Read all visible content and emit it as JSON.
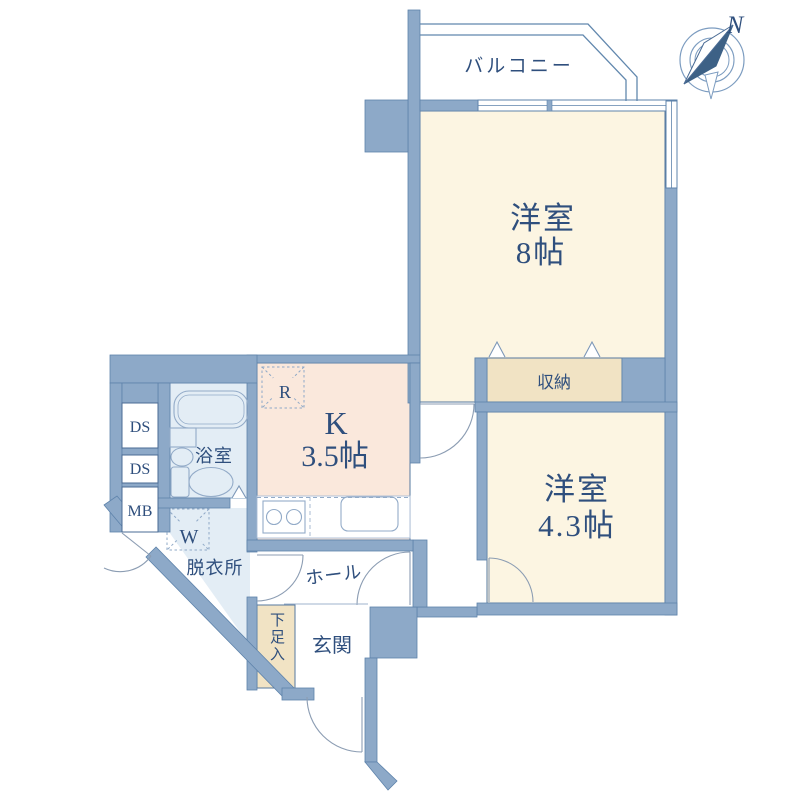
{
  "compass": {
    "north_label": "N"
  },
  "balcony": {
    "label": "バルコニー"
  },
  "rooms": {
    "western8": {
      "name": "洋室",
      "size": "8帖"
    },
    "western43": {
      "name": "洋室",
      "size": "4.3帖"
    },
    "kitchen": {
      "name": "K",
      "size": "3.5帖"
    },
    "storage": {
      "label": "収納"
    },
    "bathroom": {
      "label": "浴室"
    },
    "dressing_room": {
      "label": "脱衣所"
    },
    "hall": {
      "label": "ホール"
    },
    "entrance": {
      "label": "玄関"
    },
    "shoe_cabinet": {
      "label": "下足入"
    }
  },
  "equipment": {
    "duct_shaft_1": "DS",
    "duct_shaft_2": "DS",
    "meter_box": "MB",
    "refrigerator": "R",
    "washing_machine": "W"
  },
  "colors": {
    "wall": "#8DA9C8",
    "wall_edge": "#5E83AB",
    "room_floor": "#FCF5E2",
    "kitchen_floor": "#FAE8DC",
    "closet_floor": "#F1E3C4",
    "wet_area_floor": "#E3EDF5",
    "text": "#2F4F7D"
  }
}
